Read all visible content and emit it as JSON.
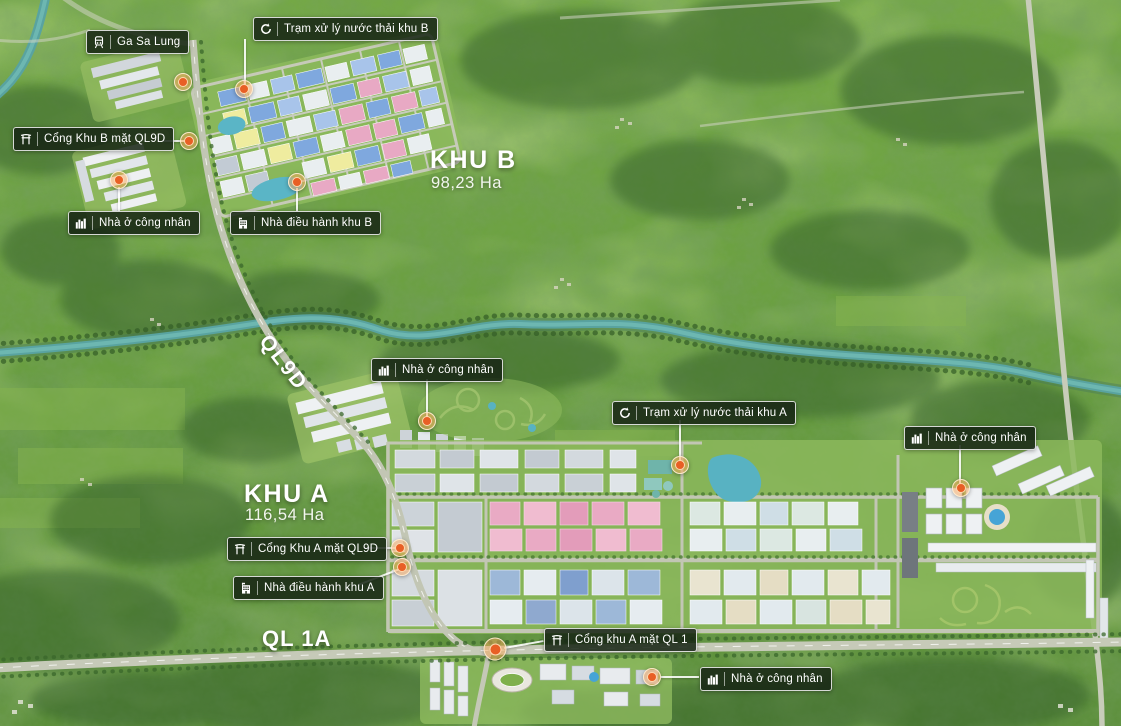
{
  "zones": [
    {
      "name": "KHU B",
      "area": "98,23 Ha"
    },
    {
      "name": "KHU A",
      "area": "116,54 Ha"
    }
  ],
  "roads": [
    {
      "name": "QL9D"
    },
    {
      "name": "QL 1A"
    }
  ],
  "callouts": [
    {
      "id": "ga-sa-lung",
      "icon": "train-icon",
      "text": "Ga Sa Lung"
    },
    {
      "id": "tram-xu-ly-khu-b",
      "icon": "recycle-icon",
      "text": "Trạm xử lý nước thải khu B"
    },
    {
      "id": "cong-khu-b",
      "icon": "gate-icon",
      "text": "Cổng Khu B mặt QL9D"
    },
    {
      "id": "nha-o-cong-nhan-khu-b",
      "icon": "buildings-icon",
      "text": "Nhà ở công nhân"
    },
    {
      "id": "nha-dieu-hanh-khu-b",
      "icon": "office-icon",
      "text": "Nhà điều hành khu B"
    },
    {
      "id": "nha-o-cong-nhan-giua",
      "icon": "buildings-icon",
      "text": "Nhà ở công nhân"
    },
    {
      "id": "tram-xu-ly-khu-a",
      "icon": "recycle-icon",
      "text": "Trạm xử lý nước thải khu A"
    },
    {
      "id": "nha-o-cong-nhan-phai",
      "icon": "buildings-icon",
      "text": "Nhà ở công nhân"
    },
    {
      "id": "cong-khu-a-ql9d",
      "icon": "gate-icon",
      "text": "Cổng Khu A mặt QL9D"
    },
    {
      "id": "nha-dieu-hanh-khu-a",
      "icon": "office-icon",
      "text": "Nhà điều hành khu A"
    },
    {
      "id": "cong-khu-a-ql1",
      "icon": "gate-icon",
      "text": "Cổng khu A mặt QL 1"
    },
    {
      "id": "nha-o-cong-nhan-duoi",
      "icon": "buildings-icon",
      "text": "Nhà ở công nhân"
    }
  ],
  "colors": {
    "marker_orange": "#e85f25",
    "marker_halo": "#f7a65a",
    "label_background": "rgba(22,36,20,0.86)",
    "label_border": "rgba(255,255,255,0.82)",
    "river_teal": "#59a3a0",
    "terrain_green": "#699e40"
  }
}
